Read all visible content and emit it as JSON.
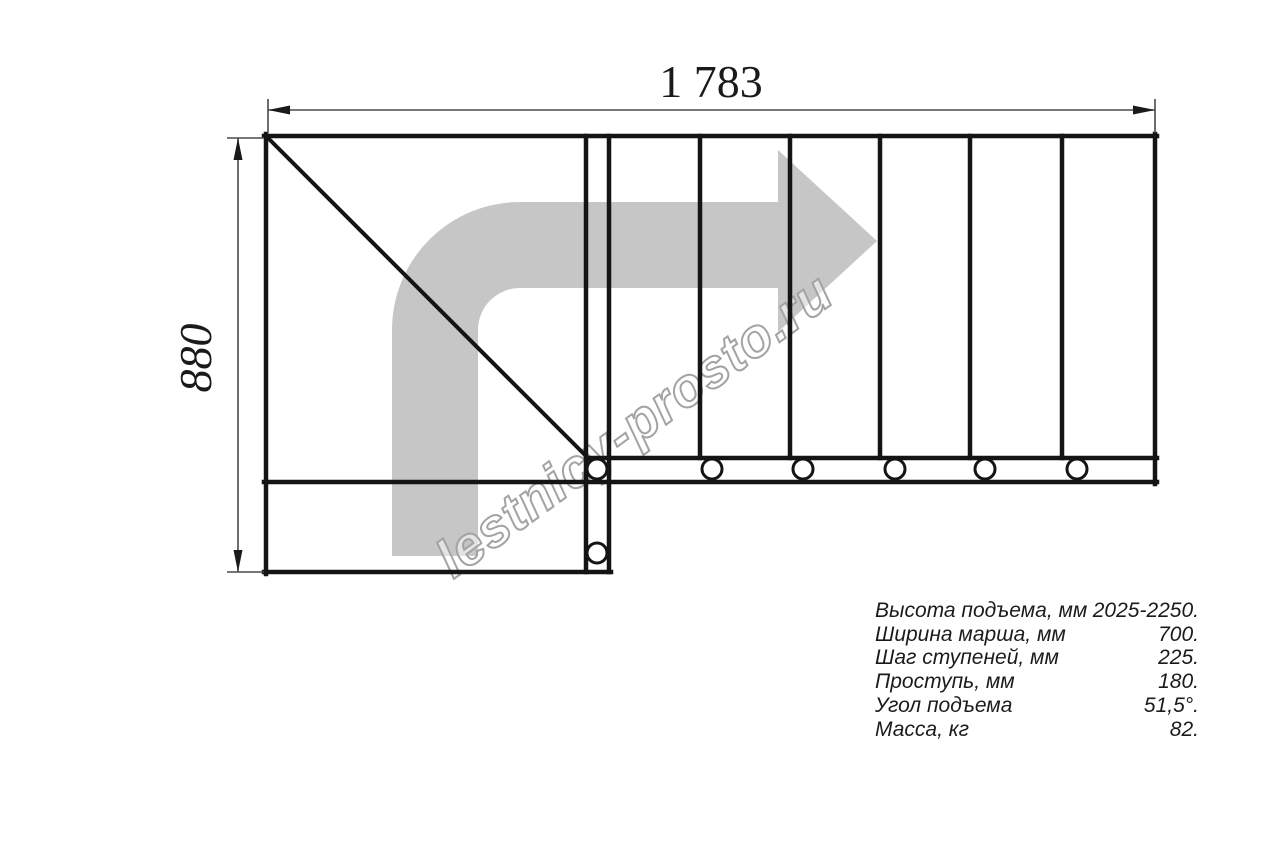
{
  "diagram": {
    "title": "staircase-plan-top-view",
    "top_dimension": "1 783",
    "left_dimension": "880",
    "watermark": "lestnicy-prosto.ru",
    "tread_count_straight_flight": 6,
    "direction_arrow": "up-then-right"
  },
  "specs": {
    "rows": [
      {
        "label": "Высота подъема, мм",
        "value": "2025-2250."
      },
      {
        "label": "Ширина марша, мм",
        "value": "700."
      },
      {
        "label": "Шаг ступеней, мм",
        "value": "225."
      },
      {
        "label": "Проступь, мм",
        "value": "180."
      },
      {
        "label": "Угол подъема",
        "value": "51,5°."
      },
      {
        "label": "Масса, кг",
        "value": "82."
      }
    ]
  },
  "colors": {
    "line": "#141414",
    "dimension_line": "#4a4a4a",
    "direction_arrow_fill": "#c6c6c6",
    "watermark_outline": "#a3a3a3",
    "background": "#ffffff"
  }
}
